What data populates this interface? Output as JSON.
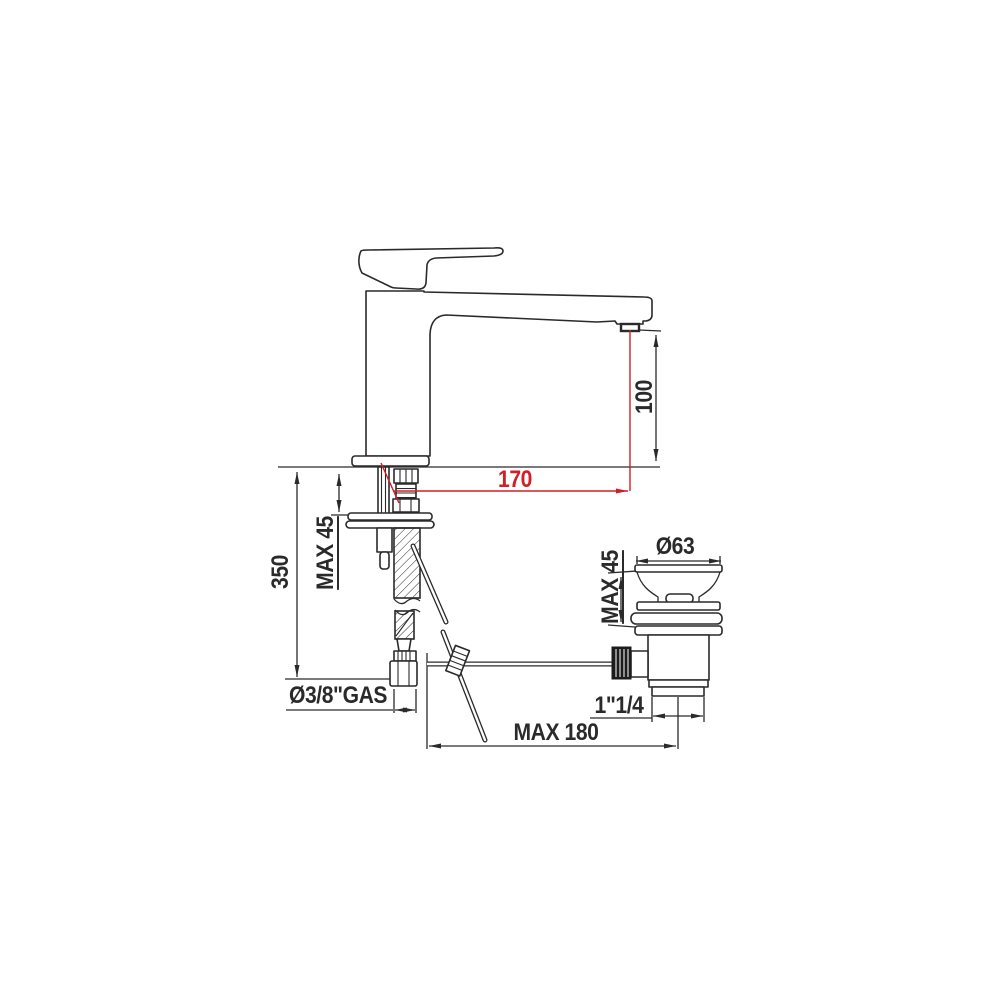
{
  "drawing": {
    "type": "technical-dimension-drawing",
    "subject": "single-lever basin mixer tap with pop-up waste drain",
    "colors": {
      "line": "#2a2a2a",
      "accent_red": "#d01f26",
      "background": "#ffffff"
    },
    "dims": {
      "d170": {
        "label": "170"
      },
      "d100": {
        "label": "100"
      },
      "d350": {
        "label": "350"
      },
      "max45_faucet": {
        "label": "MAX 45"
      },
      "d63": {
        "label": "Ø63"
      },
      "max45_drain": {
        "label": "MAX 45"
      },
      "gas": {
        "label": "Ø3/8\"GAS"
      },
      "inch114": {
        "label": "1\"1/4"
      },
      "max180": {
        "label": "MAX 180"
      }
    }
  }
}
